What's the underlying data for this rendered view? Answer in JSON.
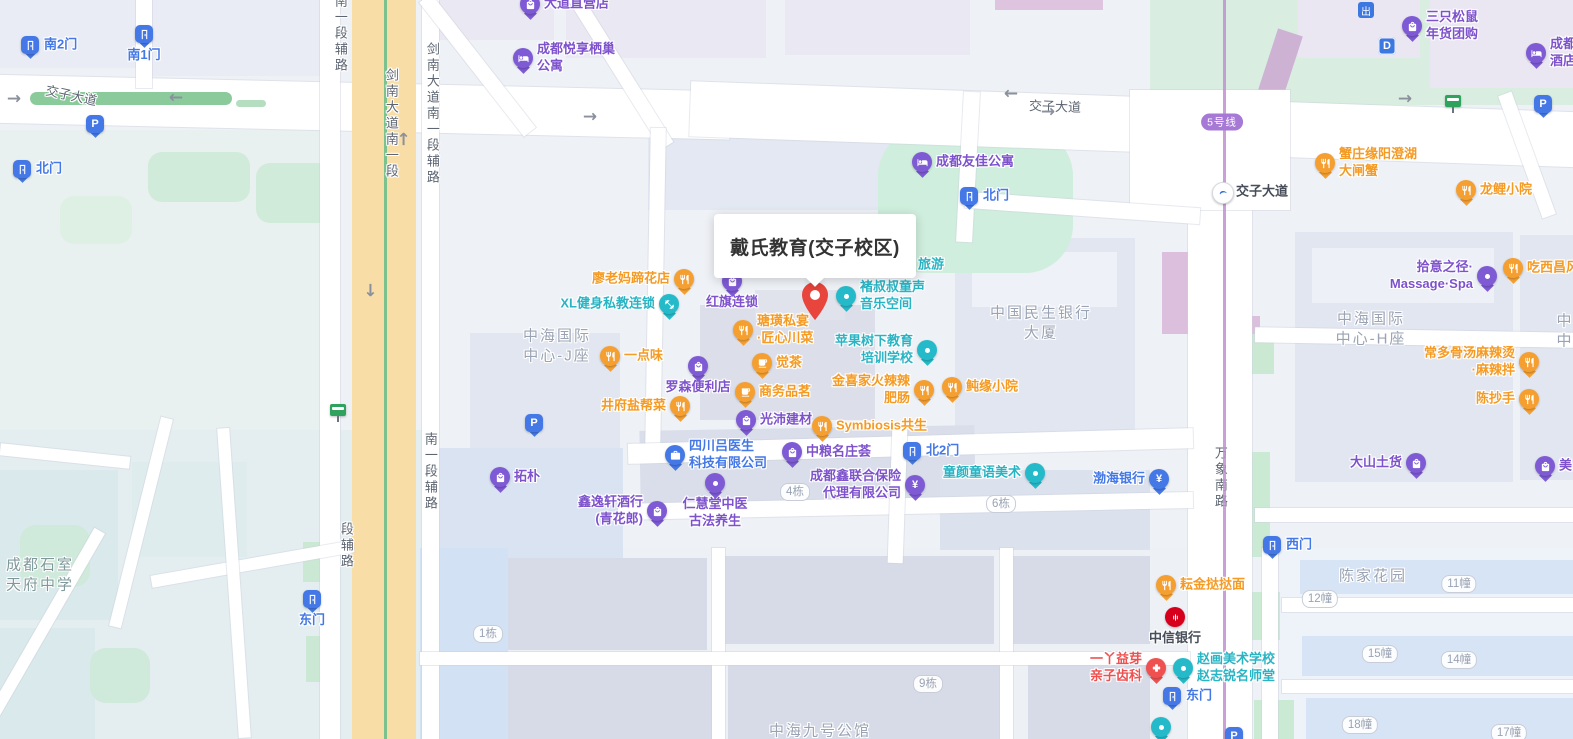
{
  "popup": {
    "title": "戴氏教育(交子校区)"
  },
  "metro": {
    "line_badge": "5号线",
    "line_badge_x": 1222,
    "line_badge_y": 122
  },
  "colors": {
    "pin": {
      "food": "#f59f31",
      "shop": "#7e5ad5",
      "edu": "#25bac9",
      "blue": "#4478e6",
      "red": "#ef5050"
    },
    "text": {
      "food": "#f59a23",
      "shop": "#7d52cc",
      "edu": "#29b4c4",
      "blue": "#4478e6",
      "red": "#ef5050",
      "dark": "#474d59"
    }
  },
  "pois": [
    {
      "label": "南2门",
      "icon": "door",
      "cat": "blue",
      "x": 30,
      "y": 45,
      "side": "right"
    },
    {
      "label": "南1门",
      "icon": "door",
      "cat": "blue",
      "x": 144,
      "y": 34,
      "side": "below"
    },
    {
      "label": "北门",
      "icon": "door",
      "cat": "blue",
      "x": 22,
      "y": 169,
      "side": "right"
    },
    {
      "label": "P",
      "icon": "P",
      "cat": "blue",
      "x": 95,
      "y": 124,
      "side": "none"
    },
    {
      "label": "大道直营店",
      "icon": "bag",
      "cat": "shop",
      "x": 530,
      "y": 4,
      "side": "right"
    },
    {
      "label": "成都悦享栖巢\n公寓",
      "icon": "bed",
      "cat": "shop",
      "x": 523,
      "y": 58,
      "side": "right"
    },
    {
      "label": "成都友佳公寓",
      "icon": "bed",
      "cat": "shop",
      "x": 922,
      "y": 162,
      "side": "right"
    },
    {
      "label": "北门",
      "icon": "door",
      "cat": "blue",
      "x": 969,
      "y": 196,
      "side": "right"
    },
    {
      "label": "交子大道",
      "icon": "station",
      "cat": "blue",
      "lcat": "dark",
      "x": 1222,
      "y": 192,
      "side": "right"
    },
    {
      "label": "出",
      "icon": "chu",
      "cat": "blue",
      "x": 1366,
      "y": 10,
      "side": "none"
    },
    {
      "label": "D",
      "icon": "D",
      "cat": "blue",
      "x": 1387,
      "y": 46,
      "side": "none"
    },
    {
      "label": "三只松鼠\n年货团购",
      "icon": "bag",
      "cat": "shop",
      "x": 1412,
      "y": 26,
      "side": "right"
    },
    {
      "label": "成都\n酒店",
      "icon": "bed",
      "cat": "shop",
      "x": 1536,
      "y": 53,
      "side": "right"
    },
    {
      "label": "",
      "icon": "bus",
      "cat": "blue",
      "x": 1453,
      "y": 104,
      "side": "none"
    },
    {
      "label": "P",
      "icon": "P",
      "cat": "blue",
      "x": 1543,
      "y": 104,
      "side": "none"
    },
    {
      "label": "蟹庄缘阳澄湖\n大闸蟹",
      "icon": "utensils",
      "cat": "food",
      "x": 1325,
      "y": 163,
      "side": "right"
    },
    {
      "label": "龙鲤小院",
      "icon": "utensils",
      "cat": "food",
      "x": 1466,
      "y": 190,
      "side": "right"
    },
    {
      "label": "廖老妈蹄花店",
      "icon": "utensils",
      "cat": "food",
      "x": 684,
      "y": 279,
      "side": "left"
    },
    {
      "label": "红旗连锁",
      "icon": "bag",
      "cat": "shop",
      "x": 732,
      "y": 281,
      "side": "below"
    },
    {
      "label": "XL健身私教连锁",
      "icon": "dumbbell",
      "cat": "edu",
      "x": 669,
      "y": 304,
      "side": "left"
    },
    {
      "label": "褚叔叔童声\n音乐空间",
      "icon": "dot",
      "cat": "edu",
      "x": 846,
      "y": 296,
      "side": "right"
    },
    {
      "label": "旅游",
      "icon": "none",
      "cat": "edu",
      "x": 918,
      "y": 265,
      "side": "right"
    },
    {
      "label": "瑭璜私宴\n·匠心川菜",
      "icon": "utensils",
      "cat": "food",
      "x": 743,
      "y": 330,
      "side": "right"
    },
    {
      "label": "苹果树下教育\n培训学校",
      "icon": "dot",
      "cat": "edu",
      "x": 927,
      "y": 350,
      "side": "left"
    },
    {
      "label": "一点味",
      "icon": "utensils",
      "cat": "food",
      "x": 610,
      "y": 356,
      "side": "right"
    },
    {
      "label": "觉茶",
      "icon": "cup",
      "cat": "food",
      "x": 762,
      "y": 363,
      "side": "right"
    },
    {
      "label": "罗森便利店",
      "icon": "bag",
      "cat": "shop",
      "x": 698,
      "y": 366,
      "side": "below"
    },
    {
      "label": "商务品茗",
      "icon": "cup",
      "cat": "food",
      "x": 745,
      "y": 392,
      "side": "right"
    },
    {
      "label": "金喜家火辣辣\n肥肠",
      "icon": "utensils",
      "cat": "food",
      "x": 924,
      "y": 390,
      "side": "left"
    },
    {
      "label": "鲀缘小院",
      "icon": "utensils",
      "cat": "food",
      "x": 952,
      "y": 387,
      "side": "right"
    },
    {
      "label": "井府盐帮菜",
      "icon": "utensils",
      "cat": "food",
      "x": 680,
      "y": 406,
      "side": "left"
    },
    {
      "label": "光沛建材",
      "icon": "bag",
      "cat": "shop",
      "x": 746,
      "y": 420,
      "side": "right"
    },
    {
      "label": "Symbiosis共生",
      "icon": "utensils",
      "cat": "food",
      "x": 822,
      "y": 426,
      "side": "right"
    },
    {
      "label": "P",
      "icon": "P",
      "cat": "blue",
      "x": 534,
      "y": 423,
      "side": "none"
    },
    {
      "label": "四川吕医生\n科技有限公司",
      "icon": "briefcase",
      "cat": "blue",
      "x": 675,
      "y": 455,
      "side": "right"
    },
    {
      "label": "中粮名庄荟",
      "icon": "bag",
      "cat": "shop",
      "x": 792,
      "y": 452,
      "side": "right"
    },
    {
      "label": "北2门",
      "icon": "door",
      "cat": "blue",
      "x": 912,
      "y": 451,
      "side": "right"
    },
    {
      "label": "成都鑫联合保险\n代理有限公司",
      "icon": "yen",
      "cat": "shop",
      "x": 915,
      "y": 485,
      "side": "left"
    },
    {
      "label": "童颜童语美术",
      "icon": "dot",
      "cat": "edu",
      "x": 1035,
      "y": 473,
      "side": "left"
    },
    {
      "label": "渤海银行",
      "icon": "yen",
      "cat": "blue",
      "x": 1159,
      "y": 479,
      "side": "left"
    },
    {
      "label": "拓朴",
      "icon": "bag",
      "cat": "shop",
      "x": 500,
      "y": 477,
      "side": "right"
    },
    {
      "label": "2栋",
      "icon": "badge",
      "cat": "blue",
      "x": 515,
      "y": 500,
      "side": "none"
    },
    {
      "label": "鑫逸轩酒行\n(青花郎)",
      "icon": "bag",
      "cat": "shop",
      "x": 657,
      "y": 511,
      "side": "left"
    },
    {
      "label": "仁慧堂中医\n古法养生",
      "icon": "dot",
      "cat": "shop",
      "x": 715,
      "y": 483,
      "side": "below"
    },
    {
      "label": "西门",
      "icon": "door",
      "cat": "blue",
      "x": 1272,
      "y": 545,
      "side": "right"
    },
    {
      "label": "拾意之径·\nMassage·Spa",
      "icon": "dot",
      "cat": "shop",
      "x": 1487,
      "y": 276,
      "side": "left"
    },
    {
      "label": "吃西昌风",
      "icon": "utensils",
      "cat": "food",
      "x": 1513,
      "y": 268,
      "side": "right"
    },
    {
      "label": "常多骨汤麻辣烫\n·麻辣拌",
      "icon": "utensils",
      "cat": "food",
      "x": 1529,
      "y": 362,
      "side": "left"
    },
    {
      "label": "陈抄手",
      "icon": "utensils",
      "cat": "food",
      "x": 1529,
      "y": 399,
      "side": "left"
    },
    {
      "label": "大山土货",
      "icon": "bag",
      "cat": "shop",
      "x": 1416,
      "y": 463,
      "side": "left"
    },
    {
      "label": "美",
      "icon": "bag",
      "cat": "shop",
      "x": 1545,
      "y": 466,
      "side": "right"
    },
    {
      "label": "耘金挞挞面",
      "icon": "utensils",
      "cat": "food",
      "x": 1166,
      "y": 585,
      "side": "right"
    },
    {
      "label": "中信银行",
      "icon": "citic",
      "cat": "red",
      "lcat": "dark",
      "x": 1175,
      "y": 617,
      "side": "below"
    },
    {
      "label": "一丫益芽\n亲子齿科",
      "icon": "cross",
      "cat": "red",
      "x": 1156,
      "y": 668,
      "side": "left"
    },
    {
      "label": "赵画美术学校\n赵志锐名师堂",
      "icon": "dot",
      "cat": "edu",
      "x": 1183,
      "y": 668,
      "side": "right"
    },
    {
      "label": "东门",
      "icon": "door",
      "cat": "blue",
      "x": 1172,
      "y": 696,
      "side": "right"
    },
    {
      "label": "",
      "icon": "dot",
      "cat": "edu",
      "x": 1161,
      "y": 727,
      "side": "none"
    },
    {
      "label": "P",
      "icon": "P",
      "cat": "blue",
      "x": 1234,
      "y": 736,
      "side": "none"
    },
    {
      "label": "东门",
      "icon": "door",
      "cat": "blue",
      "x": 312,
      "y": 599,
      "side": "below"
    },
    {
      "label": "",
      "icon": "bus",
      "cat": "blue",
      "x": 338,
      "y": 413,
      "side": "none"
    }
  ],
  "road_labels": [
    {
      "text": "交子大道",
      "x": 45,
      "y": 88,
      "rotate": 12,
      "vertical": false
    },
    {
      "text": "交子大道",
      "x": 1029,
      "y": 99,
      "rotate": 2,
      "vertical": false
    },
    {
      "text": "南一段辅路",
      "x": 331,
      "y": -6,
      "vertical": true
    },
    {
      "text": "剑南大道南一段",
      "x": 382,
      "y": 68,
      "vertical": true
    },
    {
      "text": "剑南大道南一段辅路",
      "x": 423,
      "y": 42,
      "vertical": true
    },
    {
      "text": "南一段辅路",
      "x": 421,
      "y": 432,
      "vertical": true
    },
    {
      "text": "段辅路",
      "x": 337,
      "y": 522,
      "vertical": true
    },
    {
      "text": "万象南路",
      "x": 1211,
      "y": 446,
      "vertical": true
    }
  ],
  "area_labels": [
    {
      "text": "中海国际\n中心-J座",
      "x": 557,
      "y": 346,
      "cls": ""
    },
    {
      "text": "中国民生银行\n大厦",
      "x": 1041,
      "y": 323,
      "cls": ""
    },
    {
      "text": "中海国际\n中心-H座",
      "x": 1371,
      "y": 329,
      "cls": ""
    },
    {
      "text": "陈家花园",
      "x": 1373,
      "y": 576,
      "cls": ""
    },
    {
      "text": "中海九号公馆",
      "x": 820,
      "y": 731,
      "cls": ""
    },
    {
      "text": "成都石室\n天府中学",
      "x": 40,
      "y": 575,
      "cls": "campus-label"
    },
    {
      "text": "中\n中",
      "x": 1565,
      "y": 331,
      "cls": ""
    }
  ],
  "building_badges": [
    {
      "text": "4栋",
      "x": 795,
      "y": 492
    },
    {
      "text": "6栋",
      "x": 1001,
      "y": 504
    },
    {
      "text": "1栋",
      "x": 488,
      "y": 634
    },
    {
      "text": "9栋",
      "x": 928,
      "y": 684
    },
    {
      "text": "11幢",
      "x": 1459,
      "y": 584
    },
    {
      "text": "12幢",
      "x": 1320,
      "y": 599
    },
    {
      "text": "15幢",
      "x": 1380,
      "y": 654
    },
    {
      "text": "14幢",
      "x": 1459,
      "y": 660
    },
    {
      "text": "18幢",
      "x": 1360,
      "y": 725
    },
    {
      "text": "17幢",
      "x": 1509,
      "y": 733
    }
  ],
  "arrows": [
    {
      "x": 14,
      "y": 99,
      "dir": "right"
    },
    {
      "x": 176,
      "y": 97,
      "dir": "left"
    },
    {
      "x": 590,
      "y": 117,
      "dir": "right"
    },
    {
      "x": 1011,
      "y": 93,
      "dir": "left"
    },
    {
      "x": 1048,
      "y": 112,
      "dir": "right"
    },
    {
      "x": 1405,
      "y": 99,
      "dir": "right"
    },
    {
      "x": 404,
      "y": 139,
      "dir": "up"
    },
    {
      "x": 370,
      "y": 290,
      "dir": "down"
    }
  ]
}
